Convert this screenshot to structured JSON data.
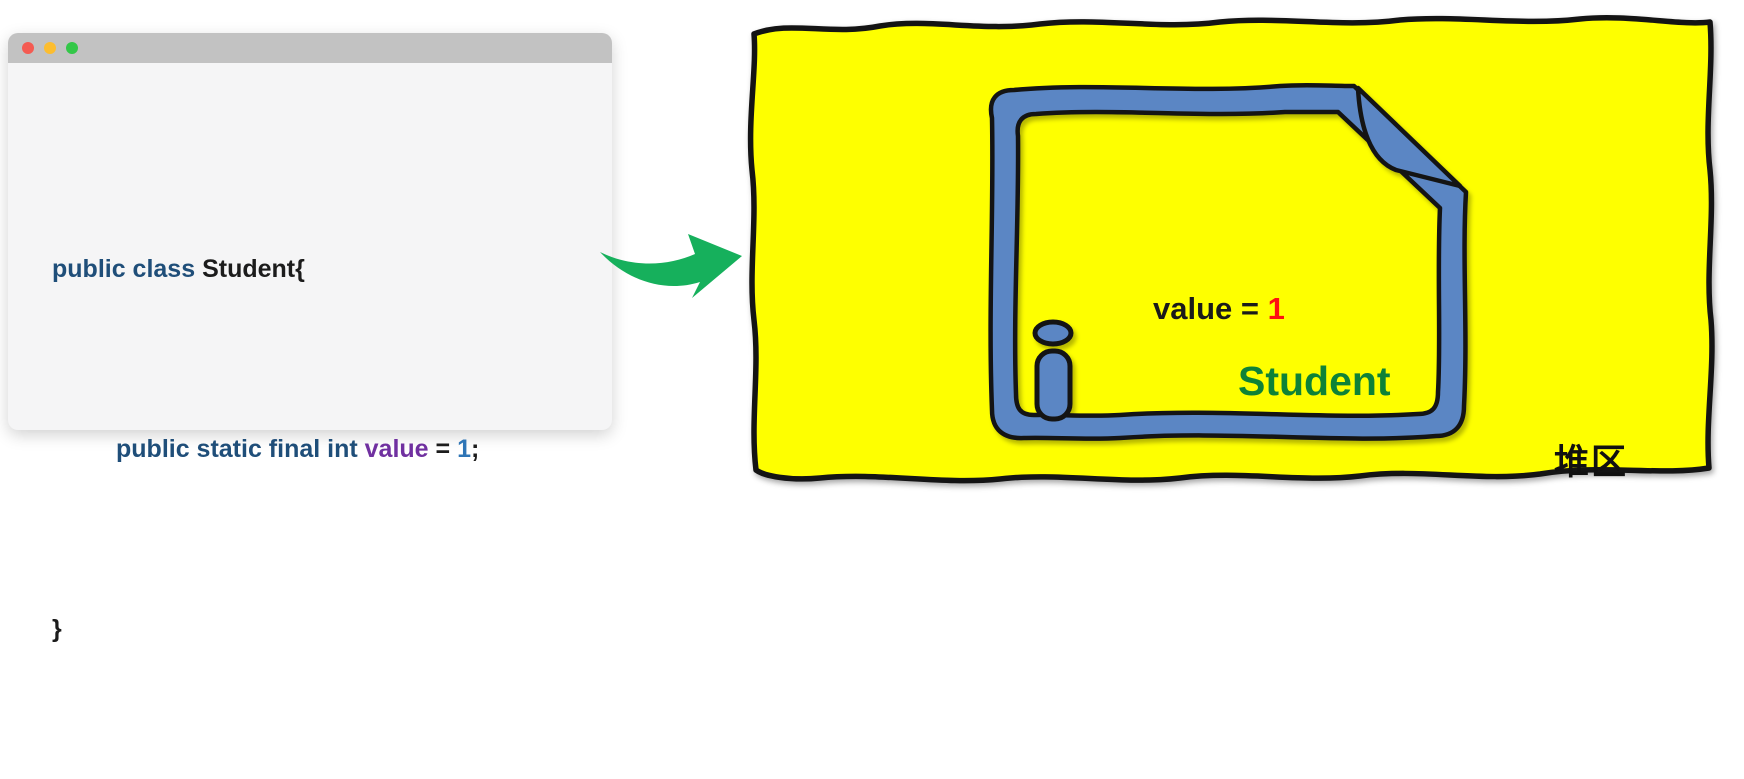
{
  "window": {
    "controls": {
      "close": "close-button",
      "minimize": "minimize-button",
      "zoom": "zoom-button"
    },
    "code": {
      "line1": {
        "keyword": "public class ",
        "class_name": "Student{"
      },
      "line2": {
        "keyword": "public static final int ",
        "field_name": "value",
        "operator": " = ",
        "number": "1",
        "punctuation": ";"
      },
      "line3": {
        "brace": "}"
      }
    }
  },
  "heap": {
    "region_label": "堆区",
    "object_card": {
      "field_assignment": {
        "label": "value = ",
        "value": "1"
      },
      "class_name": "Student"
    }
  },
  "colors": {
    "heap_fill": "#feff00",
    "outline_black": "#141414",
    "document_blue": "#5b86c4",
    "class_green": "#0e8237",
    "value_red": "#fe1111",
    "arrow_green": "#16b05c",
    "code_keyword_navy": "#1f4e79",
    "code_field_purple": "#7030a0",
    "code_number_blue": "#2e75b6",
    "titlebar_gray": "#c2c2c2",
    "window_bg": "#f5f5f6",
    "traffic_red": "#f45b52",
    "traffic_yellow": "#fcbd2f",
    "traffic_green": "#33c748"
  }
}
